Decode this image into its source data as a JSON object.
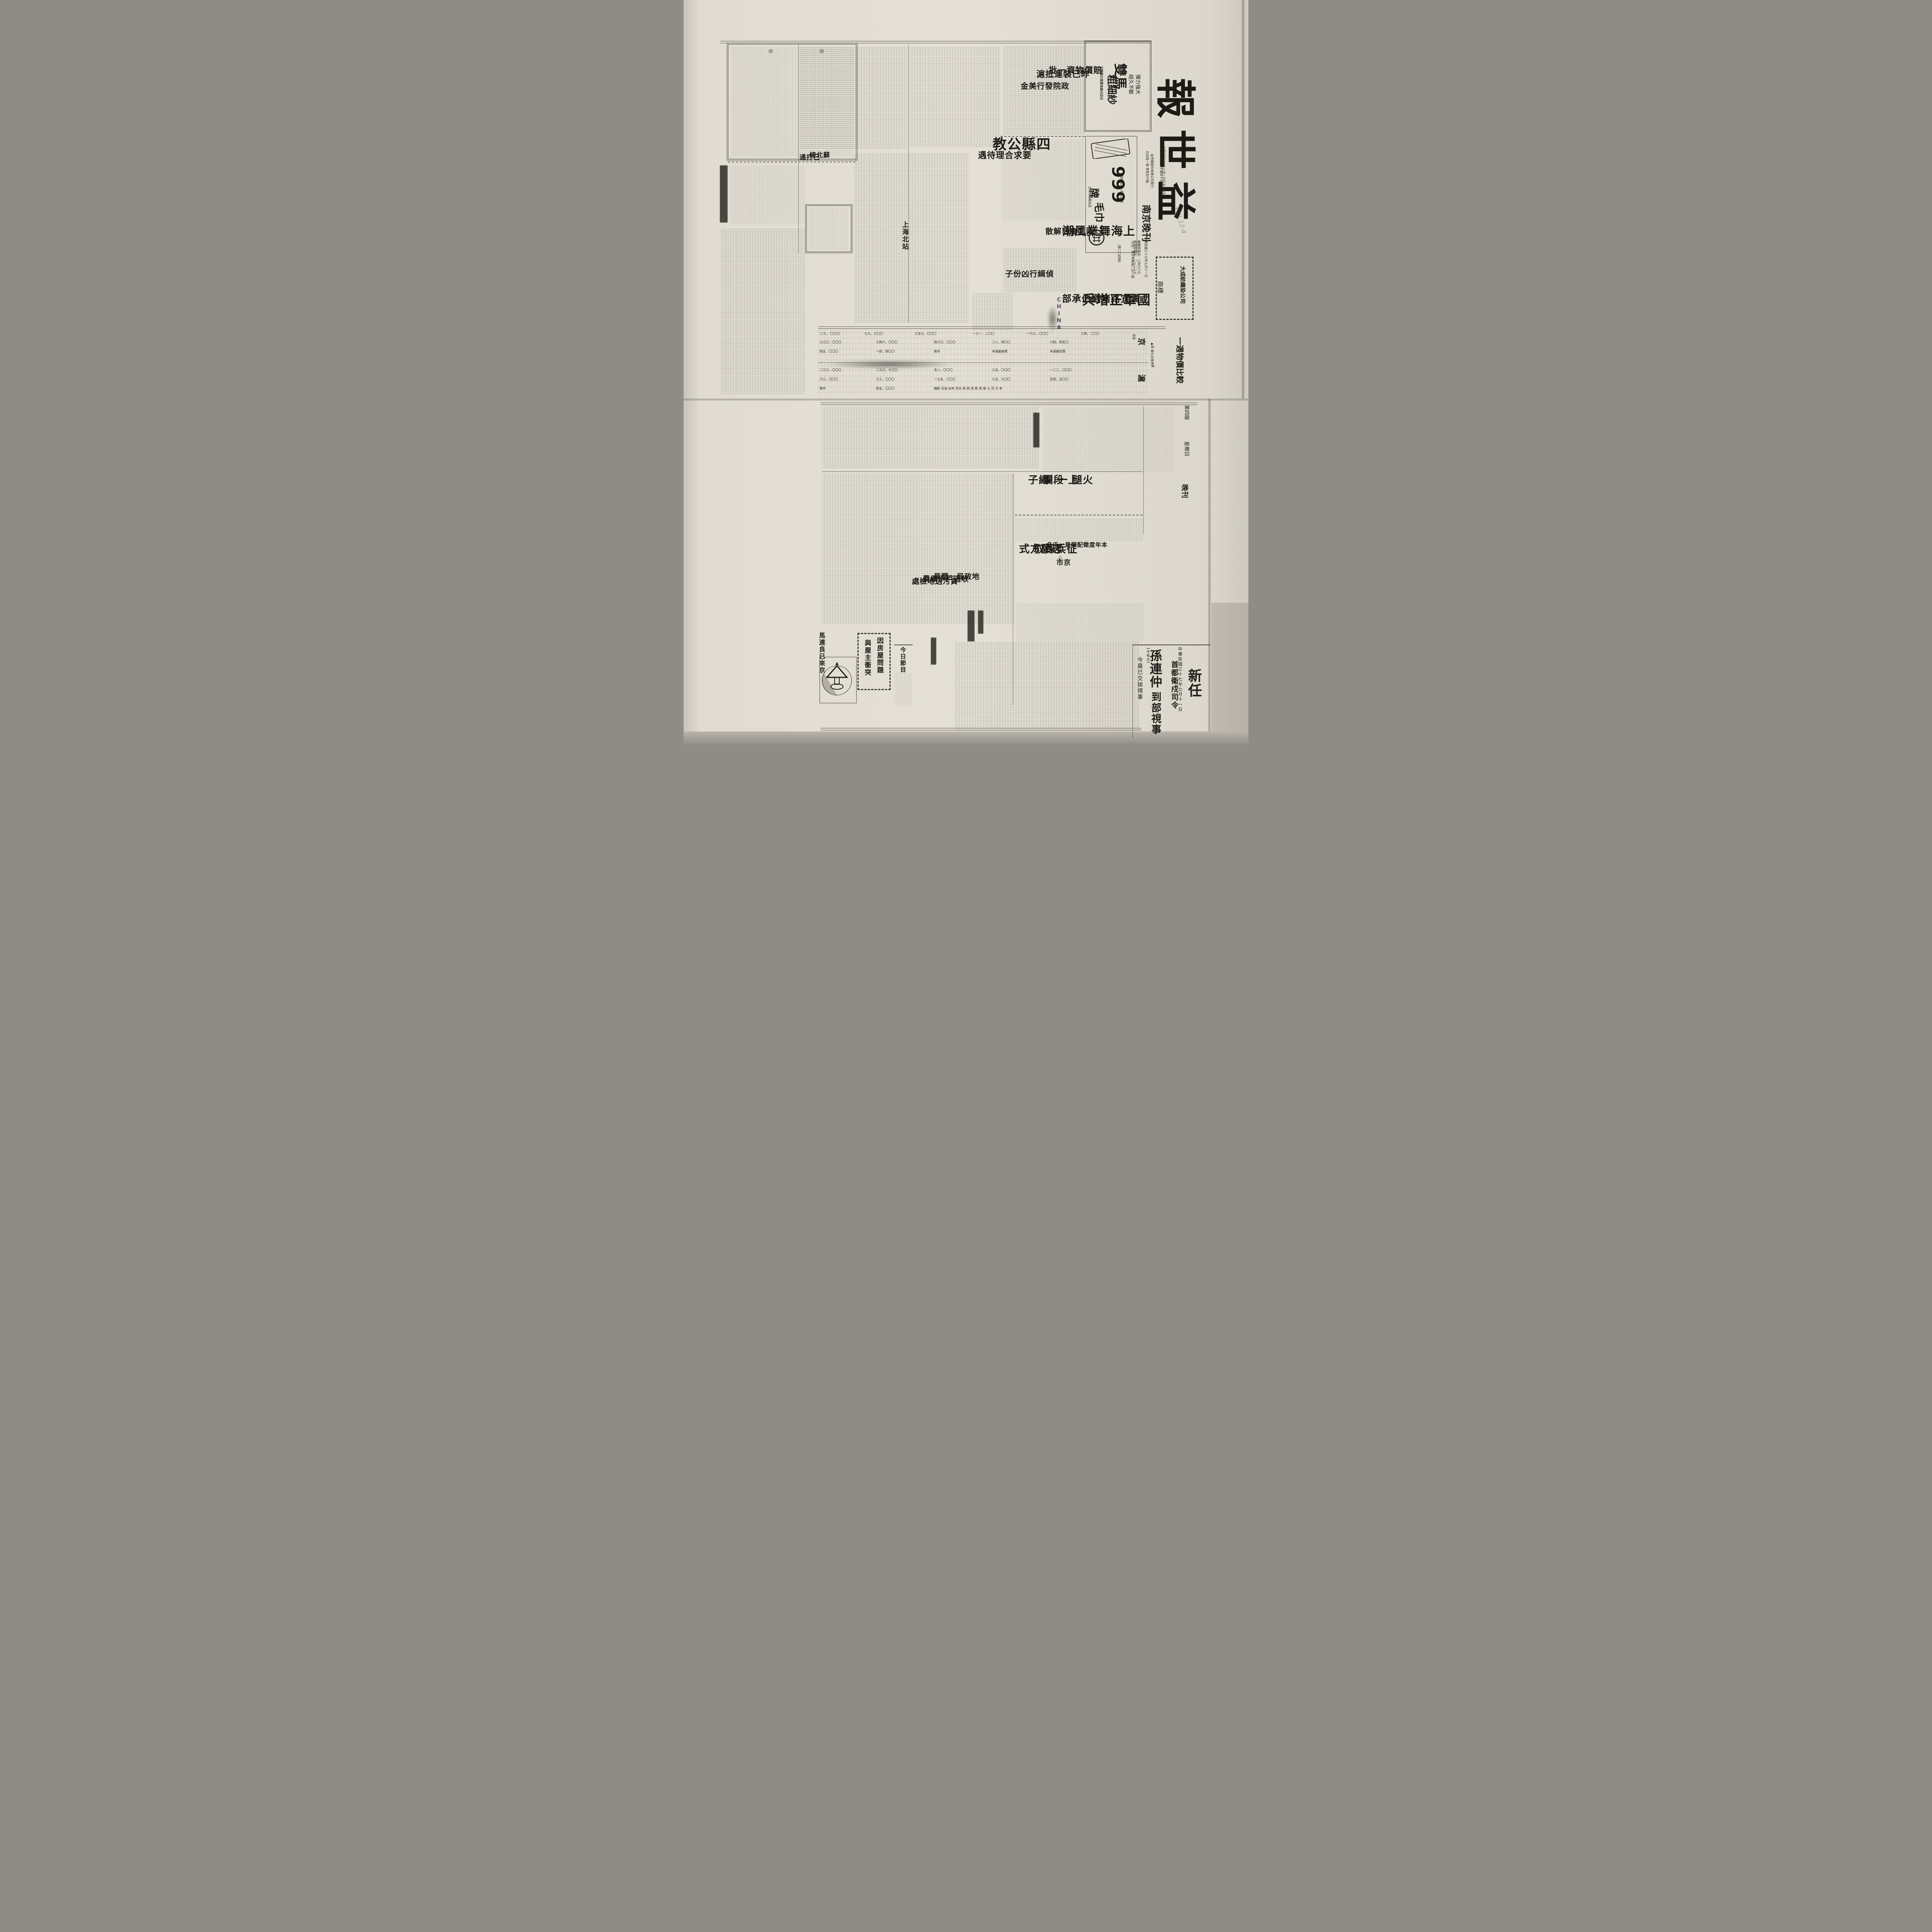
{
  "masthead": {
    "paper_name": "益世報",
    "paper_name_chars": [
      "報",
      "世",
      "益"
    ],
    "edition_label": "南京晚刊",
    "registration": "內政部登記證字第四十五號",
    "founded": "中華民國卅四年十月一日在天津創刊",
    "publisher": "益世報股份有限公司發行",
    "issue_info": "日出版一張 零售四千圓",
    "issue_no": "(第二〇四號)",
    "date_line": "中華民國三十七年七月十一日",
    "phone_editorial": "編輯部電話：二四六〇九",
    "phone_business": "經理部電話：二一二八七",
    "address": "社址：南京林森路二五八號"
  },
  "ads": {
    "shuangma": {
      "brand_top": "雙馬",
      "brand_bottom": "粗細紗",
      "slogan1": "彈力強大",
      "slogan2": "經久不斷",
      "maker": "申新紡織第九廠出品",
      "office": "管理處：江西路四一〇號"
    },
    "nines": {
      "numerals": "999",
      "unit": "牌",
      "product": "毛巾",
      "tagline": "質料高貴・經久耐用",
      "maker": "上海棉織廠出品"
    },
    "dacheng": {
      "company": "大成紡織染公司",
      "label": "商標"
    }
  },
  "price_table": {
    "title": "一週物價比較",
    "legend_up": "▲漲",
    "legend_down": "×跌",
    "unit": "單位法幣元",
    "name_header": "貨名",
    "col_header_high": "本週最高價",
    "col_header_low": "本週最低價",
    "section_jing": "京",
    "section_hu": "滬",
    "no_market": "無市",
    "commodity_chars": "糆粉 豆油 白布 月白 馬 明 金 斯 皂 柴 火 司 力 本",
    "rows_jing": [
      "二九、〇〇〇",
      "七九、三〇〇",
      "三五七、〇〇〇",
      "一三一、二〇〇",
      "一六三、〇〇〇",
      "三四、二〇〇",
      "三三〇、〇〇〇",
      "三四六、〇〇〇",
      "四六〇、〇〇〇",
      "二八、四〇〇",
      "六四、四五〇",
      "四五、〇〇〇",
      "一四、四〇〇"
    ],
    "rows_hu": [
      "二三〇、〇〇〇",
      "二九〇、七〇〇",
      "五八、〇〇〇",
      "三五、〇〇〇",
      "一二二、〇〇〇",
      "六三、〇〇〇",
      "三三、〇〇〇",
      "一七五、〇〇〇",
      "七五、九〇〇",
      "五四、五〇〇",
      "無市",
      "四五、〇〇〇"
    ]
  },
  "top_page": {
    "editorial_bullet": "◎",
    "agency_tag": "【本報訊】",
    "headlines": {
      "gongjiao_main": "四縣公教",
      "gongjiao_sub": "要求合理待遇",
      "wuchao_main": "上海舞業風潮",
      "wuchao_sub1": "兩工會已解散",
      "wuchao_sub2": "偵緝行凶份子",
      "pay_kicker": "政院發行美金",
      "pay_line1": "賠償物資一批",
      "pay_line2": "昨已裝運抵滬",
      "guojun_line1": "國軍正增兵",
      "guojun_line2": "漢宜路堵劉伯承部",
      "datong_col1": "蘇北線",
      "datong_col2": "已打通",
      "beizhan": "上海北站"
    }
  },
  "bottom_page": {
    "header": {
      "page_no": "第四版",
      "weekday": "星期日",
      "edition": "晚刊",
      "dateline": "中華民國三十七年七月十一日"
    },
    "headlines": {
      "sun_kicker": "新任",
      "sun_kicker2": "首都衛戍司令",
      "sun_main": "孫連仲",
      "sun_main2": "到部視事",
      "sun_sub": "今晨已交接視事",
      "ham_c1": "火腿",
      "ham_c2": "上一",
      "ham_c3": "段爛",
      "ham_c4": "繩子",
      "conscript_kicker": "△△△",
      "conscript_kicker2": "京市",
      "conscript_bold": "本年度徵配額是一千名",
      "conscript_main1": "征兵採取",
      "conscript_main2": "志願方式",
      "land_1": "地政局一職員",
      "land_2": "收過戶手續費",
      "land_3": "貪污送地檢處",
      "house_1": "因房屋問題",
      "house_2": "與屋主衝突",
      "ma_lianliang": "馬連良已來京",
      "program_header": "今日節目"
    }
  },
  "stamp": {
    "text": "CHINA"
  },
  "scribble": {
    "text": "¥13.12-4"
  }
}
